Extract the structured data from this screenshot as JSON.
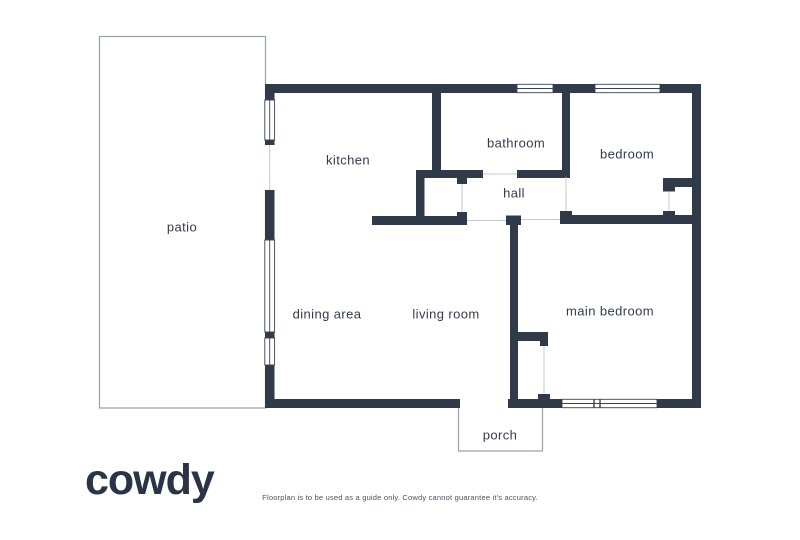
{
  "brand": {
    "logo_text": "cowdy"
  },
  "disclaimer": "Floorplan is to be used as a guide only. Cowdy cannot guarantee it's accuracy.",
  "colors": {
    "wall": "#313a49",
    "room_label_text": "#333b4d",
    "thin_outline": "#9aa1a9",
    "opening_line": "#c5cad1",
    "logo": "#2b3447",
    "disclaimer_text": "#4a5360",
    "background": "#ffffff"
  },
  "rooms": [
    {
      "name": "patio"
    },
    {
      "name": "kitchen"
    },
    {
      "name": "bathroom"
    },
    {
      "name": "bedroom"
    },
    {
      "name": "hall"
    },
    {
      "name": "dining area"
    },
    {
      "name": "living room"
    },
    {
      "name": "main bedroom"
    },
    {
      "name": "porch"
    }
  ]
}
